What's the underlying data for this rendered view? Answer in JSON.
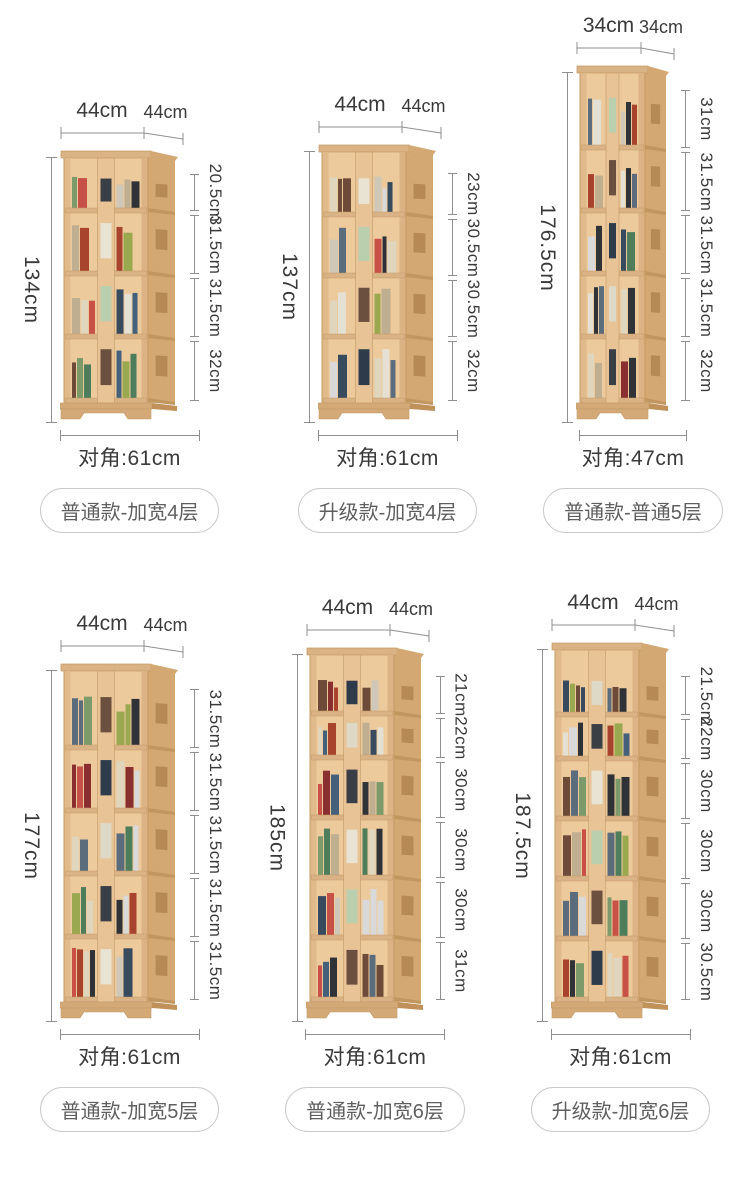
{
  "colors": {
    "background": "#ffffff",
    "dim_line": "#8f8f8f",
    "dim_text": "#3a3a3a",
    "badge_text": "#5f5f5f",
    "badge_border": "#c9c9c9",
    "wood_front": "#ecca9c",
    "wood_side": "#d3a873",
    "wood_frame": "#c49a66",
    "wood_shelf": "#d9b285",
    "wood_plinth": "#d2a977"
  },
  "rows": [
    [
      {
        "width_label": "44cm",
        "depth_label": "44cm",
        "height_label": "134cm",
        "sections": [
          "20.5cm",
          "31.5cm",
          "31.5cm",
          "32cm"
        ],
        "diagonal_label": "对角:61cm",
        "badge": "普通款-加宽4层"
      },
      {
        "width_label": "44cm",
        "depth_label": "44cm",
        "height_label": "137cm",
        "sections": [
          "23cm",
          "30.5cm",
          "30.5cm",
          "32cm"
        ],
        "diagonal_label": "对角:61cm",
        "badge": "升级款-加宽4层"
      },
      {
        "width_label": "34cm",
        "depth_label": "34cm",
        "height_label": "176.5cm",
        "sections": [
          "31cm",
          "31.5cm",
          "31.5cm",
          "31.5cm",
          "32cm"
        ],
        "diagonal_label": "对角:47cm",
        "badge": "普通款-普通5层"
      }
    ],
    [
      {
        "width_label": "44cm",
        "depth_label": "44cm",
        "height_label": "177cm",
        "sections": [
          "31.5cm",
          "31.5cm",
          "31.5cm",
          "31.5cm",
          "31.5cm"
        ],
        "diagonal_label": "对角:61cm",
        "badge": "普通款-加宽5层"
      },
      {
        "width_label": "44cm",
        "depth_label": "44cm",
        "height_label": "185cm",
        "sections": [
          "21cm",
          "22cm",
          "30cm",
          "30cm",
          "30cm",
          "31cm"
        ],
        "diagonal_label": "对角:61cm",
        "badge": "普通款-加宽6层"
      },
      {
        "width_label": "44cm",
        "depth_label": "44cm",
        "height_label": "187.5cm",
        "sections": [
          "21.5cm",
          "22cm",
          "30cm",
          "30cm",
          "30cm",
          "30.5cm"
        ],
        "diagonal_label": "对角:61cm",
        "badge": "升级款-加宽6层"
      }
    ]
  ]
}
